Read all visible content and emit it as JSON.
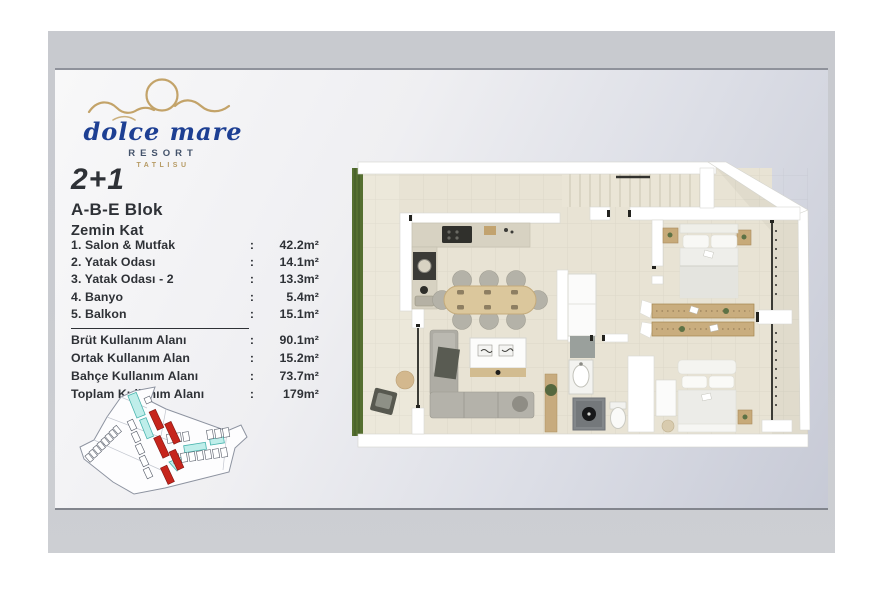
{
  "logo": {
    "brand": "dolce mare",
    "subtitle": "RESORT",
    "location": "TATLISU"
  },
  "unit": {
    "type": "2+1",
    "block": "A-B-E Blok",
    "floor": "Zemin Kat"
  },
  "areas": {
    "separator": ":",
    "rooms": [
      {
        "label": "1. Salon & Mutfak",
        "value": "42.2m²"
      },
      {
        "label": "2. Yatak Odası",
        "value": "14.1m²"
      },
      {
        "label": "3. Yatak Odası - 2",
        "value": "13.3m²"
      },
      {
        "label": "4. Banyo",
        "value": "5.4m²"
      },
      {
        "label": "5. Balkon",
        "value": "15.1m²"
      }
    ],
    "totals": [
      {
        "label": "Brüt Kullanım Alanı",
        "value": "90.1m²"
      },
      {
        "label": "Ortak Kullanım Alan",
        "value": "15.2m²"
      },
      {
        "label": "Bahçe Kullanım Alanı",
        "value": "73.7m²"
      },
      {
        "label": "Toplam Kullanım Alanı",
        "value": "179m²"
      }
    ]
  },
  "colors": {
    "brand_blue": "#1d3f93",
    "brand_gold": "#c3a369",
    "subtitle_gray_blue": "#44536b",
    "site_block_red": "#c6251c",
    "pool_cyan": "#bfeeea",
    "hedge_green": "#556f30",
    "floor_beige": "#e8e3d4"
  }
}
